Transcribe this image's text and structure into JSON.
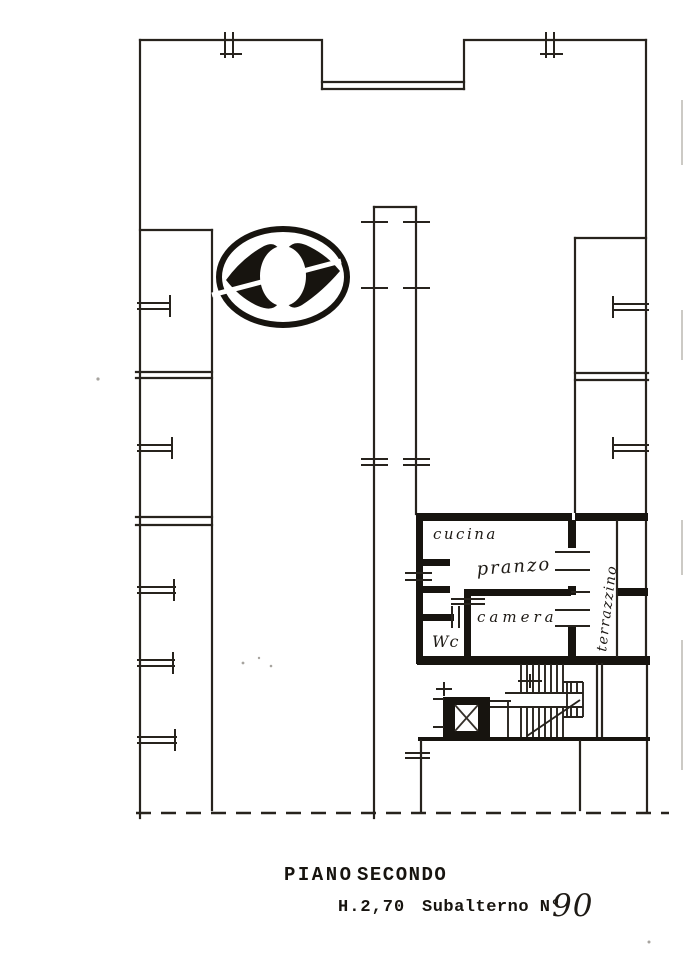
{
  "plan": {
    "rooms": {
      "cucina": "cucina",
      "pranzo": "pranzo",
      "camera": "camera",
      "wc": "Wc",
      "terrazzino": "terrazzino"
    },
    "caption": {
      "floor_word1": "PIANO",
      "floor_word2": "SECONDO",
      "height": "H.2,70",
      "subalterno_label": "Subalterno N°",
      "subalterno_number": "90"
    },
    "colors": {
      "ink": "#27231d",
      "wall": "#17140f",
      "paper": "#ffffff"
    },
    "icons": {
      "stamp": "cadastral-office-stamp-icon",
      "elevator": "elevator-shaft-icon",
      "stairs": "staircase-icon"
    }
  }
}
